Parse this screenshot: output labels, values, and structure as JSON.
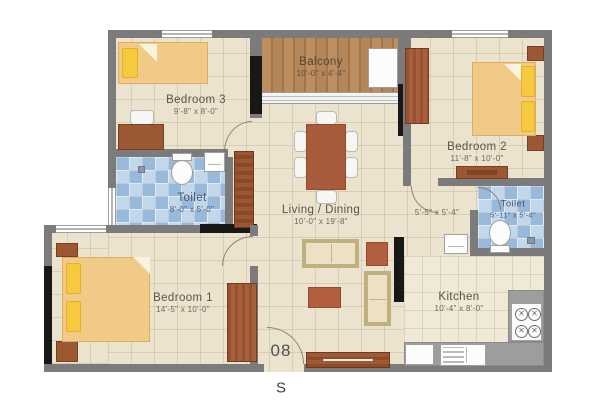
{
  "plan": {
    "unit_number": "08",
    "compass_direction": "S",
    "rooms": {
      "bedroom3": {
        "name": "Bedroom 3",
        "dims": "9'-8\" x 8'-0\""
      },
      "balcony": {
        "name": "Balcony",
        "dims": "10'-0\" x 4'-4\""
      },
      "bedroom2": {
        "name": "Bedroom 2",
        "dims": "11'-8\" x 10'-0\""
      },
      "toilet_left": {
        "name": "Toilet",
        "dims": "8'-0\" x 5'-0\""
      },
      "living_dining": {
        "name": "Living / Dining",
        "dims": "10'-0\" x 19'-8\""
      },
      "toilet_right": {
        "name": "Toilet",
        "dims": "5'-11\" x 5'-4\""
      },
      "passage": {
        "dims": "5'-5\" x 5'-4\""
      },
      "bedroom1": {
        "name": "Bedroom 1",
        "dims": "14'-5\" x 10'-0\""
      },
      "kitchen": {
        "name": "Kitchen",
        "dims": "10'-4\" x 8'-0\""
      }
    },
    "colors": {
      "wall": "#7b7b7b",
      "floor_beige": "#ece3cf",
      "toilet_tile_blue": "#a9c6e2",
      "balcony_wood": "#b5885a",
      "bed_tan": "#f0ca86",
      "pillow_yellow": "#f7c93e",
      "furniture_wood": "#9c5733",
      "accent_red": "#b25f3f",
      "label_text": "#57524a"
    }
  }
}
